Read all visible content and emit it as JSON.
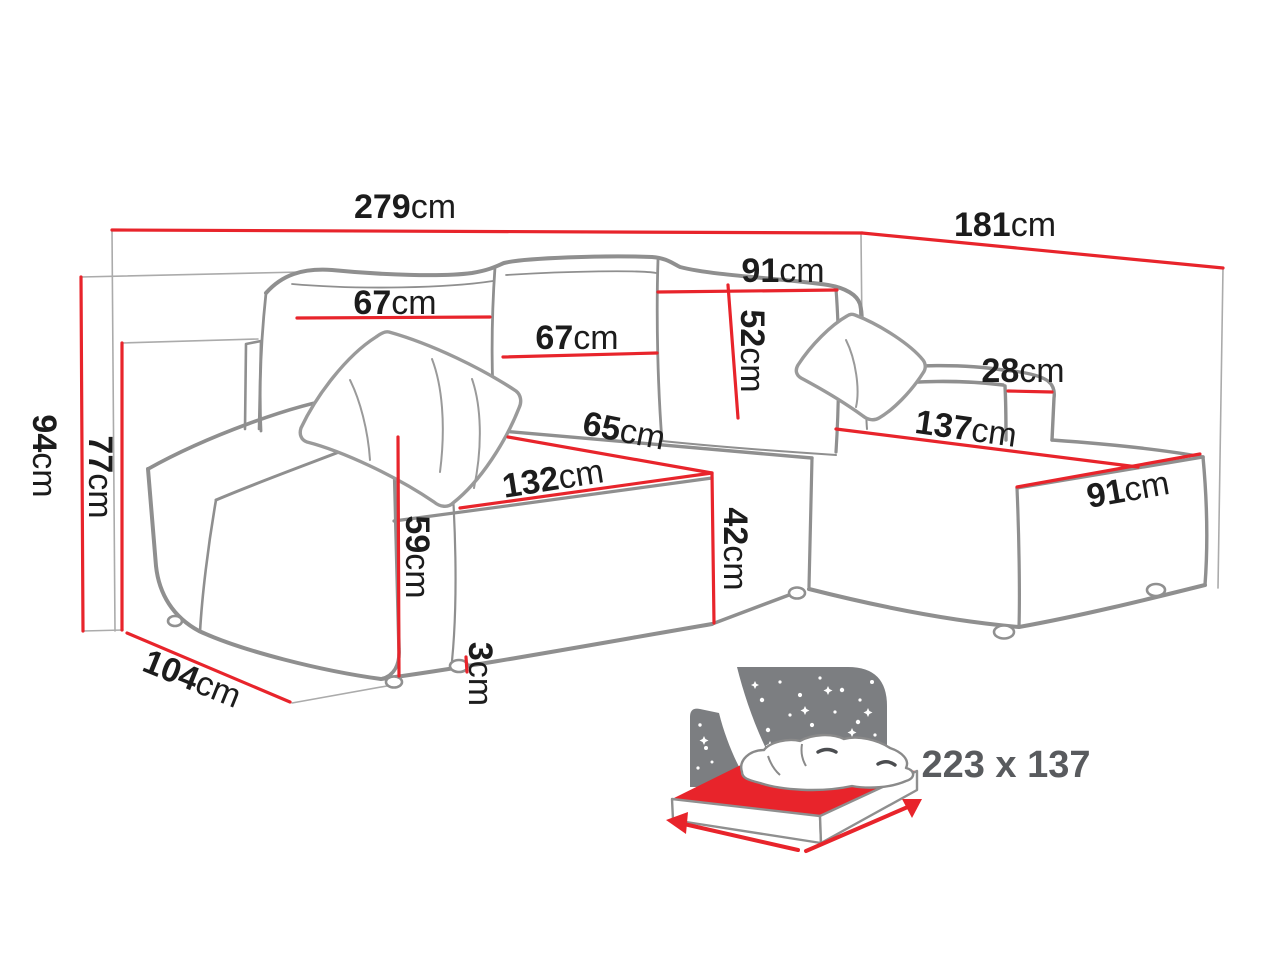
{
  "diagram": {
    "title": "corner-sofa-dimension-diagram",
    "unit": "cm",
    "colors": {
      "dimension_line": "#e8242b",
      "sofa_outline": "#8f8f8f",
      "guide_line": "#ababab",
      "label_text": "#1c1c1c",
      "icon_gray": "#7c7e81",
      "sleeping_label_gray": "#595b5e"
    },
    "dims": {
      "total_width": {
        "num": "279",
        "unit": "cm"
      },
      "total_depth": {
        "num": "181",
        "unit": "cm"
      },
      "total_height": {
        "num": "94",
        "unit": "cm"
      },
      "backrest_height": {
        "num": "77",
        "unit": "cm"
      },
      "side_depth": {
        "num": "104",
        "unit": "cm"
      },
      "back_cushion_left": {
        "num": "67",
        "unit": "cm"
      },
      "back_cushion_middle": {
        "num": "67",
        "unit": "cm"
      },
      "back_cushion_corner": {
        "num": "91",
        "unit": "cm"
      },
      "back_cushion_height": {
        "num": "52",
        "unit": "cm"
      },
      "armrest_width": {
        "num": "28",
        "unit": "cm"
      },
      "seat_depth": {
        "num": "65",
        "unit": "cm"
      },
      "seat_width": {
        "num": "132",
        "unit": "cm"
      },
      "seat_height": {
        "num": "42",
        "unit": "cm"
      },
      "armrest_height": {
        "num": "59",
        "unit": "cm"
      },
      "leg_height": {
        "num": "3",
        "unit": "cm"
      },
      "chaise_length": {
        "num": "137",
        "unit": "cm"
      },
      "chaise_width": {
        "num": "91",
        "unit": "cm"
      }
    },
    "sleeping_function": {
      "icon": "sofa-bed-night-function-icon",
      "dimensions_label": "223 x 137"
    }
  }
}
